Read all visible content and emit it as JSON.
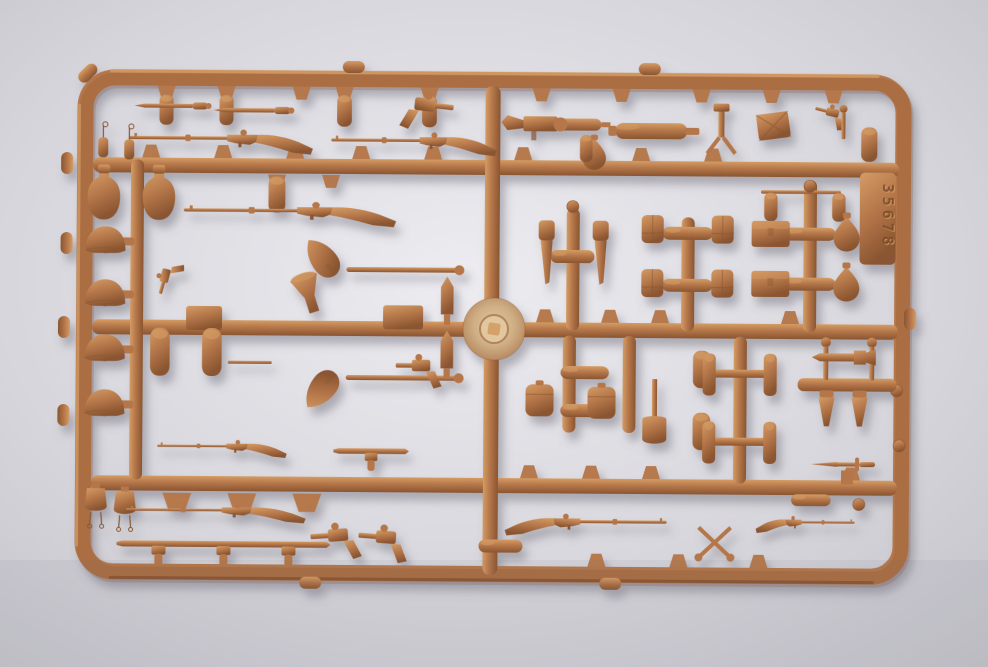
{
  "scene": {
    "type": "photograph",
    "subject": "injection-molded plastic sprue of 1/35 scale model weapon and equipment parts on a light gray surface",
    "sprue_number": "35678",
    "plastic_color_name": "tan-brown plastic",
    "background_name": "light gray backdrop"
  },
  "colors": {
    "background_center": "#edecf1",
    "background_mid": "#d6d5db",
    "background_edge": "#c3c2c9",
    "plastic_base": "#b5774a",
    "plastic_light": "#d49c64",
    "plastic_dark": "#8a5530",
    "plastic_deep": "#6f4023",
    "disc_light": "#e0c7a0",
    "disc_mid": "#cfae84",
    "disc_edge": "#b3835a",
    "shadow": "#8f8d98"
  },
  "parts_inventory": [
    {
      "name": "rifles",
      "count": 7
    },
    {
      "name": "bayonets",
      "count": 6
    },
    {
      "name": "winged-bayonets",
      "count": 4
    },
    {
      "name": "holsters-scabbards",
      "count": 2
    },
    {
      "name": "helmets",
      "count": 4
    },
    {
      "name": "shovels",
      "count": 3
    },
    {
      "name": "canteens-flasks-bottles",
      "count": 12
    },
    {
      "name": "ammo-pouches",
      "count": 4
    },
    {
      "name": "ammo-boxes",
      "count": 2
    },
    {
      "name": "machine-guns",
      "count": 3
    },
    {
      "name": "pistols",
      "count": 5
    },
    {
      "name": "grenades",
      "count": 7
    },
    {
      "name": "binoculars",
      "count": 2
    },
    {
      "name": "map-case",
      "count": 1
    },
    {
      "name": "injection-gate-disc",
      "count": 1
    }
  ]
}
